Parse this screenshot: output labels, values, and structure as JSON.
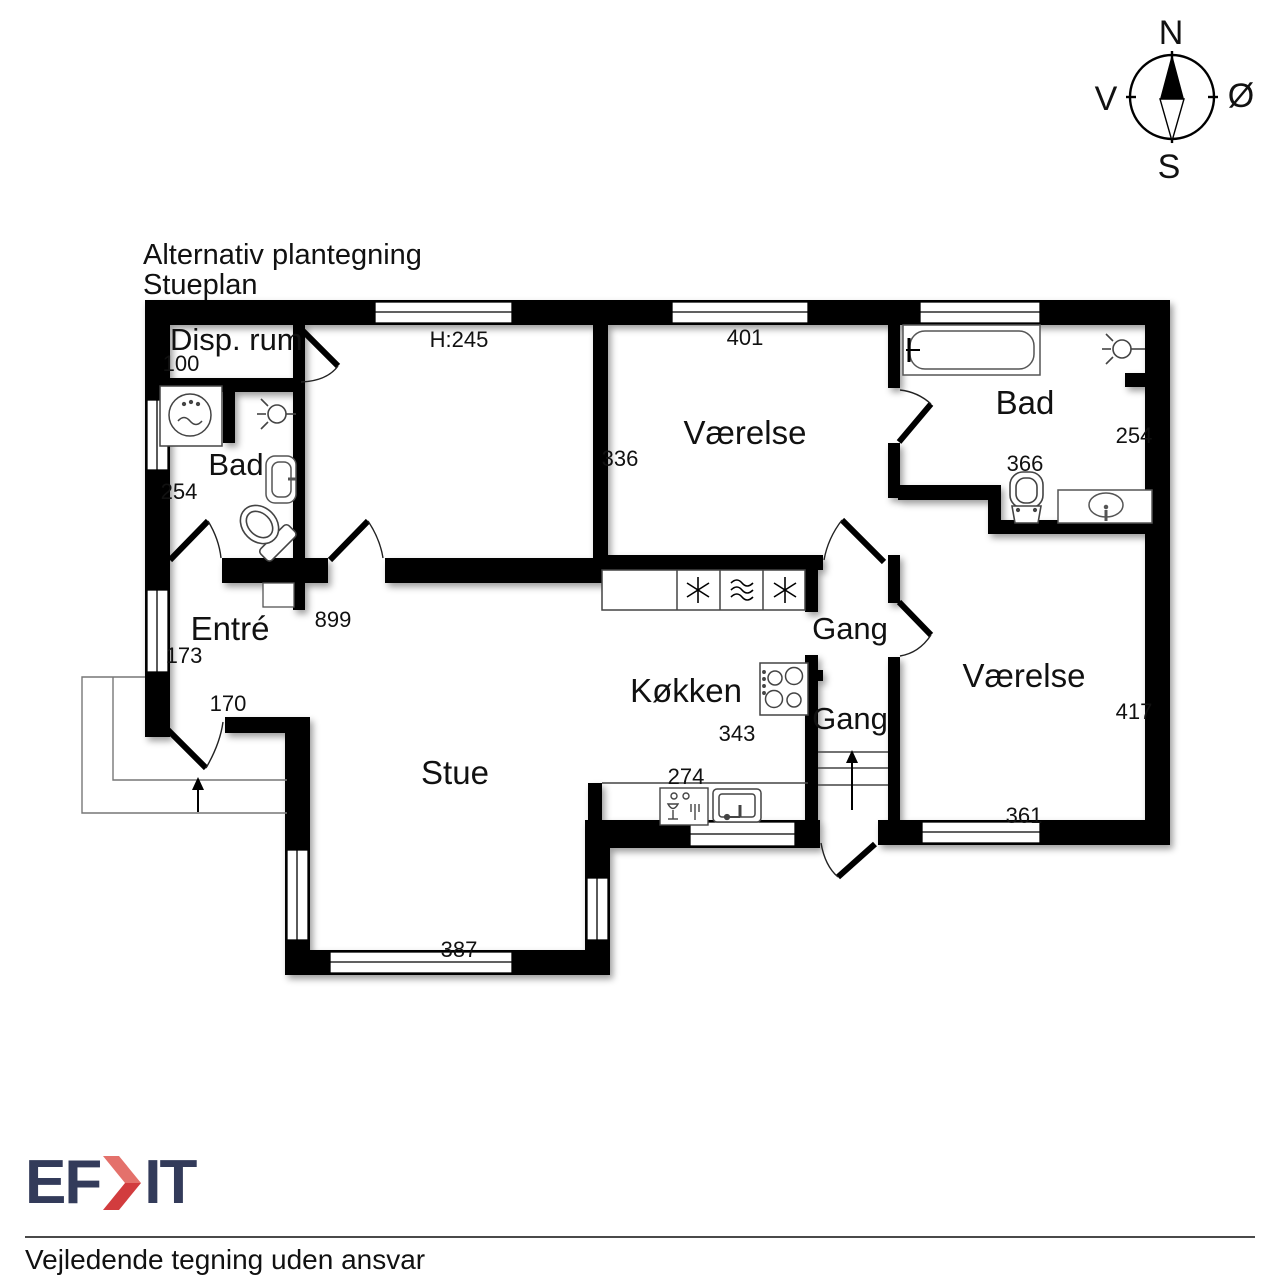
{
  "title": {
    "line1": "Alternativ plantegning",
    "line2": "Stueplan"
  },
  "compass": {
    "north": "N",
    "south": "S",
    "west": "V",
    "east": "Ø"
  },
  "rooms": {
    "disp_rum": {
      "label": "Disp. rum",
      "width": "100"
    },
    "main_room": {
      "ceiling_height": "H:245"
    },
    "bad_left": {
      "label": "Bad",
      "depth": "254"
    },
    "entre": {
      "label": "Entré",
      "depth": "173",
      "door_width": "170",
      "wall_length": "899"
    },
    "stue": {
      "label": "Stue",
      "width": "387"
    },
    "kokken": {
      "label": "Køkken",
      "depth": "343",
      "width": "274"
    },
    "vaerelse_mid": {
      "label": "Værelse",
      "width": "401",
      "depth": "336"
    },
    "gang_upper": {
      "label": "Gang"
    },
    "gang_lower": {
      "label": "Gang"
    },
    "bad_right": {
      "label": "Bad",
      "depth": "254",
      "sink_wall": "366"
    },
    "vaerelse_right": {
      "label": "Værelse",
      "depth": "417",
      "width": "361"
    }
  },
  "footer": {
    "logo_text_left": "EF",
    "logo_text_right": "IT",
    "disclaimer": "Vejledende tegning uden ansvar"
  },
  "colors": {
    "wall": "#000000",
    "room_fill": "#ffffff",
    "logo_navy": "#333b5a",
    "logo_red_light": "#e4716b",
    "logo_red_dark": "#d23c3e"
  },
  "icons": [
    "compass-rose-icon",
    "washing-machine-icon",
    "ceiling-lamp-icon",
    "sink-icon",
    "toilet-icon",
    "bathtub-icon",
    "freezer-icon",
    "oven-icon",
    "stove-icon",
    "dishwasher-icon",
    "kitchen-sink-icon",
    "stairs-up-icon",
    "entry-arrow-icon",
    "door-swing-icon",
    "window-icon"
  ]
}
